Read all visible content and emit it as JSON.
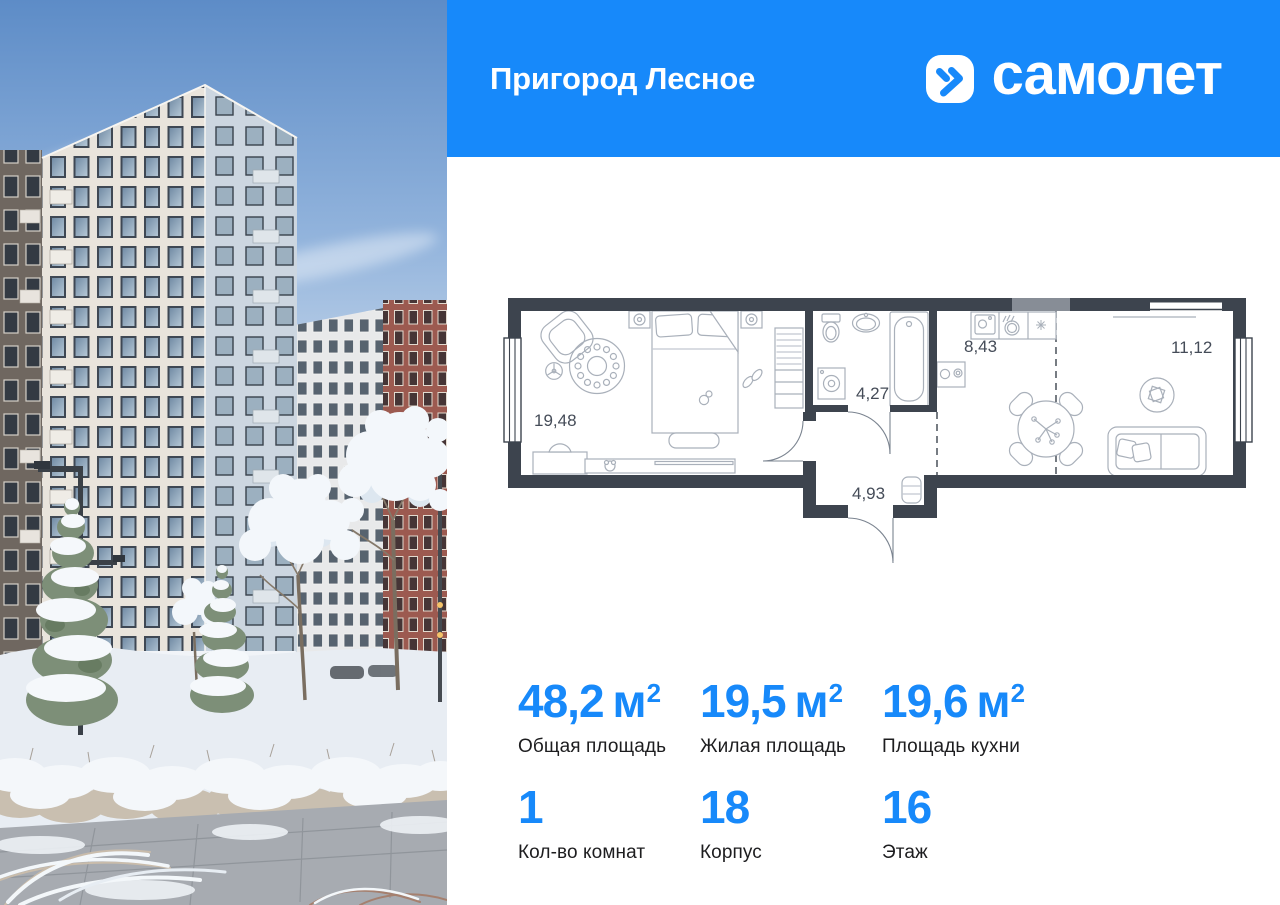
{
  "colors": {
    "accent": "#1789fa",
    "plan_walls": "#3d444e"
  },
  "header": {
    "project_name": "Пригород Лесное",
    "brand": "самолет"
  },
  "floor_plan": {
    "areas": {
      "bedroom": "19,48",
      "bathroom": "4,27",
      "hallway": "4,93",
      "kitchen": "8,43",
      "living": "11,12"
    }
  },
  "stats": {
    "items": [
      {
        "value": "48,2",
        "unit": "м",
        "sup": "2",
        "label": "Общая площадь"
      },
      {
        "value": "19,5",
        "unit": "м",
        "sup": "2",
        "label": "Жилая площадь"
      },
      {
        "value": "19,6",
        "unit": "м",
        "sup": "2",
        "label": "Площадь кухни"
      },
      {
        "value": "1",
        "unit": "",
        "sup": "",
        "label": "Кол-во комнат"
      },
      {
        "value": "18",
        "unit": "",
        "sup": "",
        "label": "Корпус"
      },
      {
        "value": "16",
        "unit": "",
        "sup": "",
        "label": "Этаж"
      }
    ]
  }
}
